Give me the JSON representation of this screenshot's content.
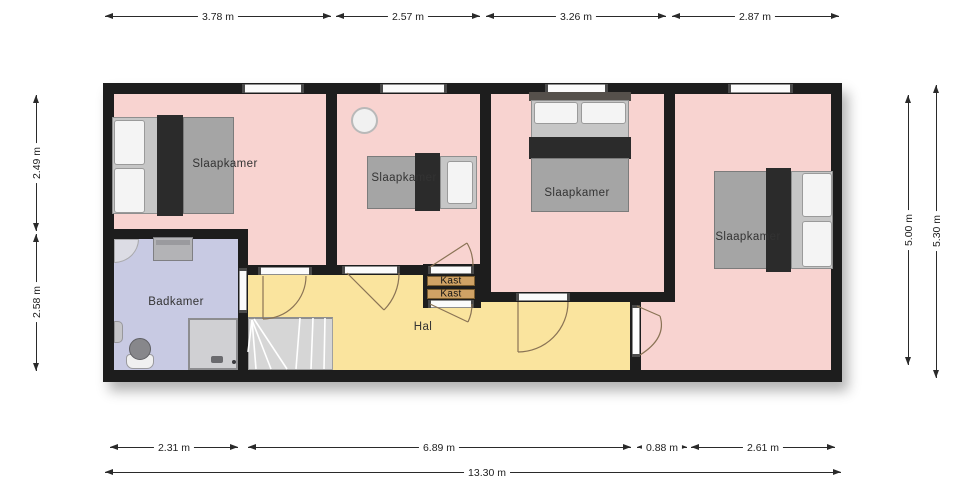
{
  "plan": {
    "title": "first floor plan",
    "unit": "m"
  },
  "rooms": {
    "bedroom1": "Slaapkamer",
    "bedroom2": "Slaapkamer",
    "bedroom3": "Slaapkamer",
    "bedroom4": "Slaapkamer",
    "bathroom": "Badkamer",
    "hall": "Hal",
    "closet_top": "Kast",
    "closet_bottom": "Kast"
  },
  "dimensions": {
    "top": [
      "3.78 m",
      "2.57 m",
      "3.26 m",
      "2.87 m"
    ],
    "left": [
      "2.49 m",
      "2.58 m"
    ],
    "right": [
      "5.00 m",
      "5.30 m"
    ],
    "bottom": [
      "2.31 m",
      "6.89 m",
      "0.88 m",
      "2.61 m"
    ],
    "total_width": "13.30 m"
  },
  "colors": {
    "bedroom_fill": "#f8d3d0",
    "bathroom_fill": "#c8cae3",
    "hall_fill": "#fae49e",
    "closet_fill": "#cfa265",
    "wall": "#1d1d1d"
  }
}
